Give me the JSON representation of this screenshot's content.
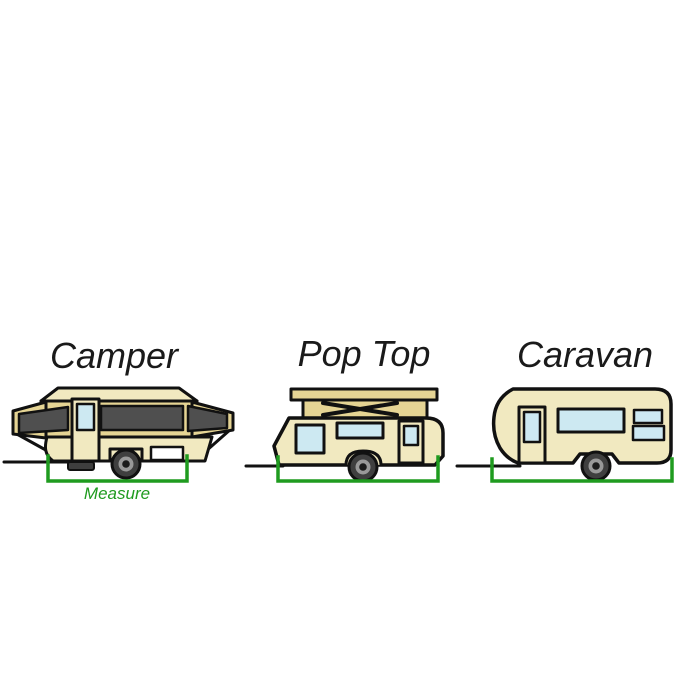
{
  "diagram": {
    "description_semantic": "Three trailer types with measurement guide",
    "vehicles": [
      {
        "id": "camper",
        "label": "Camper"
      },
      {
        "id": "pop-top",
        "label": "Pop Top"
      },
      {
        "id": "caravan",
        "label": "Caravan"
      }
    ],
    "measure_label": "Measure",
    "colors": {
      "outline": "#111111",
      "body_cream": "#f1e9c0",
      "roof_tan": "#e5d494",
      "canvas_grey": "#4f4f4f",
      "window_blue": "#cde9f2",
      "measure_green": "#1f9b1f",
      "tire_grey": "#3f3f3f",
      "rim_grey": "#999999",
      "hub_dark": "#1c1c1c",
      "hatch_white": "#ffffff",
      "label_ink": "#1a1a1a"
    }
  }
}
